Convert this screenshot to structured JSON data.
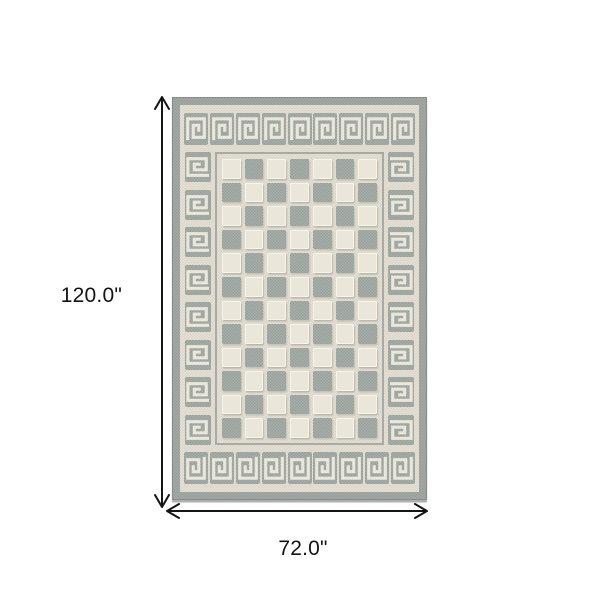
{
  "diagram": {
    "type": "product-dimension-diagram",
    "subject": "area rug with greek-key border and checkerboard field",
    "height_label": "120.0\"",
    "width_label": "72.0\""
  },
  "rug": {
    "pattern": "greek-key meander border, 12x7 checkerboard field",
    "border_motifs": {
      "top": 9,
      "bottom": 9,
      "left": 8,
      "right": 8
    },
    "field_grid": {
      "rows": 12,
      "cols": 7,
      "start_color": "cream"
    },
    "colors": {
      "background": "#ffffff",
      "cream": "#ebe6da",
      "field": "#e6e1d5",
      "field_dark": "#dad5c8",
      "gray": "#98a09c",
      "gray_light": "#a9afab",
      "edge": "#a6aba7",
      "edge_dark": "#969c98",
      "edge_line": "#878d89",
      "annotation": "#141414"
    }
  }
}
